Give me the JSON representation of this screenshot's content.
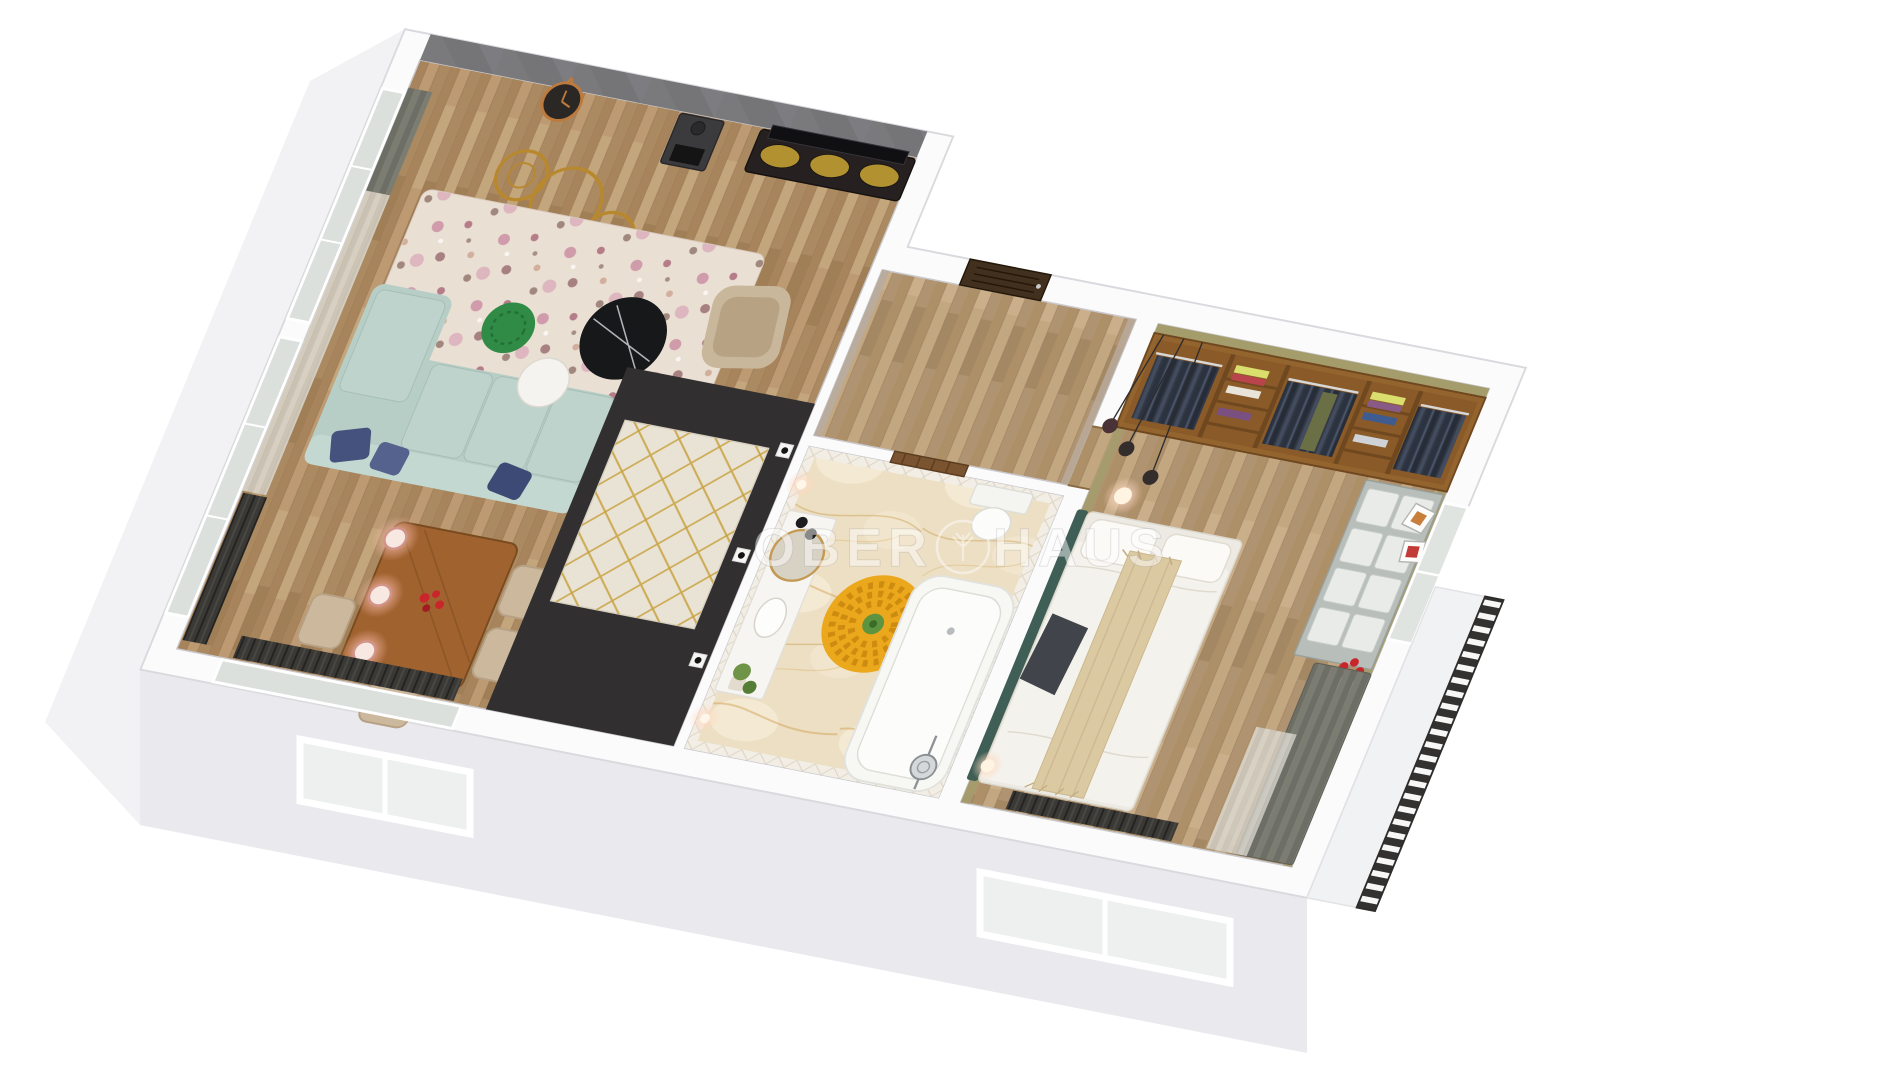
{
  "image": {
    "kind": "3d-apartment-floor-plan-render",
    "background": "#ffffff",
    "view": "top-down cutaway perspective"
  },
  "watermark": {
    "left": "OBER",
    "right": "HAUS",
    "emblem": "tree-in-circle",
    "color": "rgba(255,255,255,0.48)"
  },
  "colors": {
    "background": "#ffffff",
    "wall_top": "#fbfbfc",
    "side_face": "#f2f2f5",
    "side_face_dark": "#e9e9ee",
    "floor_wood_living": "#b3906a",
    "floor_wood_bedroom": "#b89c78",
    "accent_wall": "#757577",
    "dark_floor": "#312f30",
    "sofa": "#b7cec7",
    "sofa_light": "#c3d8d1",
    "sofa_cushion": "#bdd3cc",
    "pillow_navy": "#46527e",
    "rug_base": "#eadfd3",
    "rug_floral_pink": "#c88ea2",
    "coffee_table": "#17181a",
    "side_table": "#f5f3ef",
    "pouf": "#2f8b45",
    "armchair": "#c9b79c",
    "dining_table": "#a0622e",
    "chair": "#cbb89d",
    "pendant_glow": "#ffd9c2",
    "marble_floor": "#ecdfc4",
    "quilt_wall": "#f2eee6",
    "rug_yellow": "#eca81d",
    "rug_green": "#5e9340",
    "tub": "#f7f7f4",
    "vanity": "#f6f5f2",
    "mirror_gold": "#c39953",
    "bedroom_wall_olive": "#a59c6b",
    "closet_wood": "#94642f",
    "clothes_dark": "#39404e",
    "bed_white": "#f4f2ec",
    "runner": "#dbc9a2",
    "throw_dark": "#41444a",
    "headboard": "#3f5f56",
    "dresser": "#b8beba",
    "drawer": "#e9ebe9",
    "curtain_gray": "#6d6f66",
    "sheer": "#d8d5cc",
    "railing": "#343230",
    "radiator": "#3b3a37",
    "gold": "#b8882e",
    "door_entry": "#42301f",
    "door_bath": "#7a5330",
    "flower_red": "#c9252a",
    "watermark": "rgba(255,255,255,0.48)"
  },
  "scene": {
    "rooms": [
      {
        "name": "living-dining-room",
        "floor": "wood-planks",
        "items": [
          "accent-wall-geometric",
          "wall-clock",
          "fireplace-stove",
          "tv",
          "tv-stand-mustard-doors",
          "gold-rings-decor",
          "floral-rug",
          "corner-sofa",
          "navy-pillows",
          "black-marble-coffee-table",
          "white-side-table",
          "green-knit-pouf",
          "beige-armchair",
          "dining-table",
          "red-flower-centerpiece",
          "beige-chairs",
          "copper-pendant-lamps",
          "window-curtains",
          "radiators"
        ]
      },
      {
        "name": "kitchen-zone",
        "floor": "dark",
        "items": [
          "diamond-pattern-rug",
          "wall-sockets"
        ]
      },
      {
        "name": "hallway",
        "floor": "wood-planks",
        "items": [
          "entry-door"
        ]
      },
      {
        "name": "bathroom",
        "floor": "onyx-marble",
        "walls": "white-quilted-tile",
        "items": [
          "wooden-door",
          "vanity-unit",
          "round-gold-mirror",
          "sink",
          "black-towels",
          "plant",
          "wall-lamps",
          "yellow-pompom-rug",
          "bathtub",
          "shower-head",
          "toilet"
        ]
      },
      {
        "name": "bedroom",
        "floor": "wood-planks",
        "walls": "olive",
        "items": [
          "open-wardrobe",
          "hanging-clothes",
          "folded-clothes-stacks",
          "bed",
          "teal-headboard",
          "beige-bed-runner",
          "dark-throw",
          "pendant-sphere-lights",
          "white-dresser",
          "picture-frames",
          "vase-red-roses",
          "window",
          "gray-curtains",
          "radiator"
        ]
      },
      {
        "name": "balcony",
        "items": [
          "slatted-railing"
        ]
      }
    ]
  }
}
